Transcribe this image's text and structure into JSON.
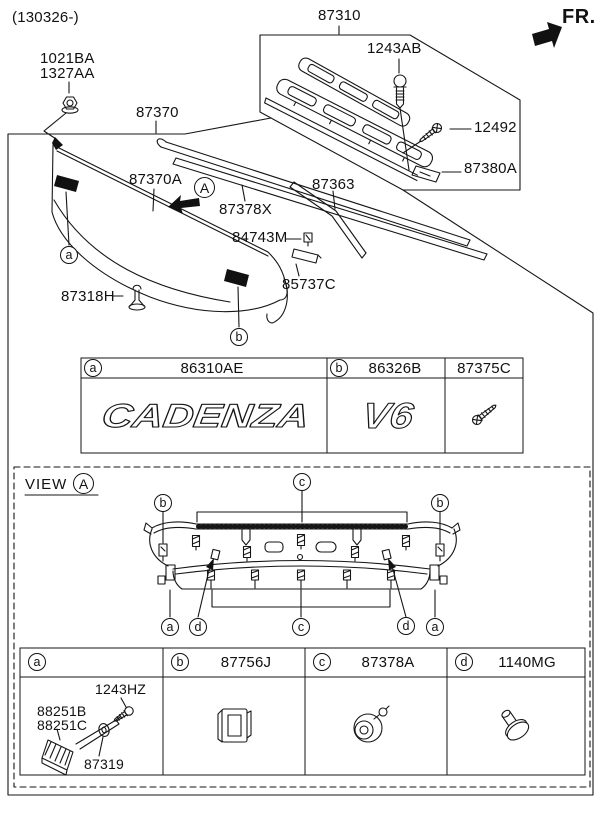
{
  "header": {
    "date_code": "(130326-)",
    "direction_label": "FR."
  },
  "main_diagram": {
    "callouts": {
      "nut_a": "1021BA",
      "nut_b": "1327AA",
      "molding": "87370",
      "detail_box": "87310",
      "screw_top": "1243AB",
      "screw_side": "12492",
      "strip_lower": "87380A",
      "garnish_panel": "87370A",
      "strip_mid": "87378X",
      "strip_right": "87363",
      "clip_small": "84743M",
      "end_cap": "85737C",
      "clip_bottom": "87318H"
    },
    "view_arrow_letter": "A",
    "position_markers": {
      "a": "a",
      "b": "b"
    }
  },
  "emblem_table": {
    "columns": [
      {
        "marker": "a",
        "part_no": "86310AE",
        "emblem_text": "CADENZA"
      },
      {
        "marker": "b",
        "part_no": "86326B",
        "emblem_text": "V6"
      },
      {
        "marker": "",
        "part_no": "87375C",
        "emblem_text": ""
      }
    ]
  },
  "view_section": {
    "title": "VIEW",
    "view_letter": "A",
    "markers": {
      "a": "a",
      "b": "b",
      "c": "c",
      "d": "d"
    }
  },
  "fastener_table": {
    "headers": [
      {
        "marker": "a",
        "part_no": ""
      },
      {
        "marker": "b",
        "part_no": "87756J"
      },
      {
        "marker": "c",
        "part_no": "87378A"
      },
      {
        "marker": "d",
        "part_no": "1140MG"
      }
    ],
    "cell_a": {
      "screw": "1243HZ",
      "bracket_b": "88251B",
      "bracket_c": "88251C",
      "washer": "87319"
    }
  }
}
